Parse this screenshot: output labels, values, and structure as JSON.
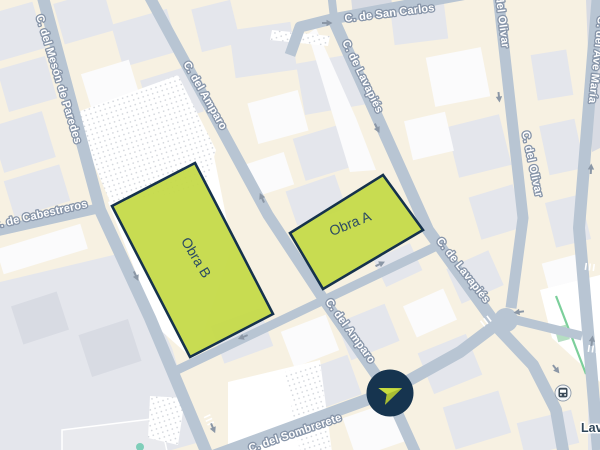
{
  "map": {
    "type": "street-map",
    "streets": {
      "meson": "C. del Mesón de Paredes",
      "cabestreros": "C. de Cabestreros",
      "amparo_upper": "C. del Amparo",
      "amparo_lower": "C. del Amparo",
      "san_carlos": "C. de San Carlos",
      "lavapies_upper": "C. de Lavapiés",
      "lavapies_lower": "C. de Lavapiés",
      "olivar_upper": "C. del Olivar",
      "olivar_lower": "C. del Olivar",
      "ave_maria": "C. del Ave María",
      "sombrerete": "C. del Sombrerete"
    },
    "zones": [
      {
        "id": "obra-b",
        "label": "Obra B"
      },
      {
        "id": "obra-a",
        "label": "Obra A"
      }
    ],
    "poi": {
      "station_label": "Lavapiés",
      "station_icon": "transit-station-icon"
    },
    "marker": {
      "icon": "navigation-arrow-icon"
    },
    "colors": {
      "land": "#f7f1e2",
      "building": "#e4e6ec",
      "building_alt": "#d8dbe3",
      "building_white": "#fbfbfc",
      "road": "#b8c5d3",
      "road_label": "#ffffff",
      "road_label_halo": "#8795a9",
      "zone_fill": "#c5da47",
      "zone_border": "#15324c",
      "zone_text": "#2b4a63",
      "marker_bg": "#16344f",
      "marker_arrow": "#c8dc3f",
      "marker_arrow_shade": "#a9bd33",
      "arrow": "#8b97a6",
      "park_line": "#7ccf9b",
      "park_fill": "#b5dec2",
      "tree": "#7fceb9",
      "station_text": "#2f4659"
    }
  }
}
